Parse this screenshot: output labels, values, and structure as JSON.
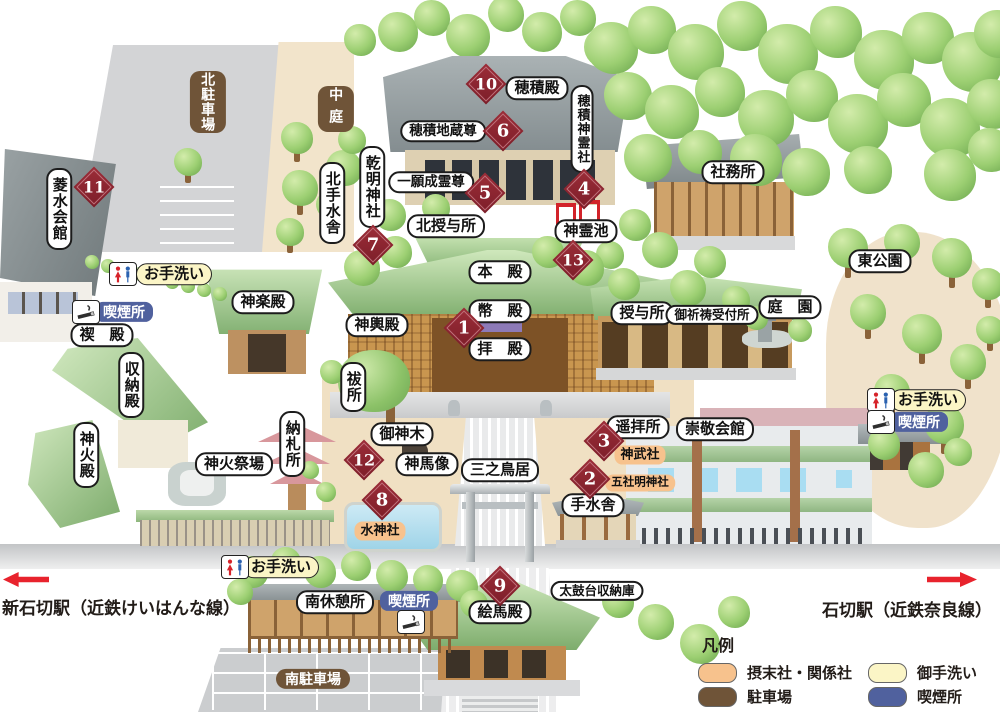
{
  "map_name": "石切神社 境内マップ",
  "colors": {
    "marker_red": "#8c2430",
    "sessha_orange": "#f7c28d",
    "parking_brown": "#6f5438",
    "toilet_yellow": "#fbf5c6",
    "smoking_blue": "#50619e",
    "arrow_red": "#e8232d"
  },
  "stations": {
    "left": "新石切駅（近鉄けいはんな線）",
    "right": "石切駅（近鉄奈良線）"
  },
  "legend": {
    "title": "凡例",
    "items": [
      {
        "id": "sessha",
        "label": "摂末社・関係社",
        "color": "#f7c28d"
      },
      {
        "id": "parking",
        "label": "駐車場",
        "color": "#6f5438"
      },
      {
        "id": "toilet",
        "label": "御手洗い",
        "color": "#fbf5c6"
      },
      {
        "id": "smoking",
        "label": "喫煙所",
        "color": "#50619e"
      }
    ]
  },
  "labels": [
    {
      "id": "kita-chushajo",
      "text": "北駐車場",
      "type": "brown",
      "v": true,
      "x": 208,
      "y": 102
    },
    {
      "id": "nakaniwa",
      "text": "中庭",
      "type": "brown",
      "v": true,
      "x": 336,
      "y": 109
    },
    {
      "id": "ryosui-kaikan",
      "text": "菱水会館",
      "type": "white",
      "v": true,
      "x": 59,
      "y": 209
    },
    {
      "id": "kita-temizusha",
      "text": "北手水舎",
      "type": "white",
      "v": true,
      "x": 332,
      "y": 203
    },
    {
      "id": "hozumi-den",
      "text": "穂積殿",
      "type": "white",
      "x": 537,
      "y": 88
    },
    {
      "id": "hozumi-shinreisha",
      "text": "穂積神霊社",
      "type": "white",
      "v": true,
      "x": 582,
      "y": 129
    },
    {
      "id": "hozumi-jizoson",
      "text": "穂積地蔵尊",
      "type": "white",
      "x": 443,
      "y": 131
    },
    {
      "id": "kenmei-jinja",
      "text": "乾明神社",
      "type": "white",
      "v": true,
      "x": 372,
      "y": 187
    },
    {
      "id": "ichigan-joreison",
      "text": "一願成霊尊",
      "type": "white",
      "x": 431,
      "y": 182
    },
    {
      "id": "shamusho",
      "text": "社務所",
      "type": "white",
      "x": 733,
      "y": 172
    },
    {
      "id": "kita-juyosho",
      "text": "北授与所",
      "type": "white",
      "x": 446,
      "y": 226
    },
    {
      "id": "shinrei-ike",
      "text": "神霊池",
      "type": "white",
      "x": 586,
      "y": 231
    },
    {
      "id": "higashi-koen",
      "text": "東公園",
      "type": "white",
      "x": 880,
      "y": 261
    },
    {
      "id": "otearai-nw",
      "text": "お手洗い",
      "type": "yellow",
      "x": 174,
      "y": 274
    },
    {
      "id": "kitsuenjo-nw",
      "text": "喫煙所",
      "type": "blue",
      "x": 124,
      "y": 312
    },
    {
      "id": "kagura-den",
      "text": "神楽殿",
      "type": "white",
      "x": 263,
      "y": 302
    },
    {
      "id": "misogi-den",
      "text": "禊　殿",
      "type": "white",
      "x": 102,
      "y": 335
    },
    {
      "id": "honden",
      "text": "本　殿",
      "type": "white",
      "x": 500,
      "y": 272
    },
    {
      "id": "heiden",
      "text": "幣　殿",
      "type": "white",
      "x": 500,
      "y": 311
    },
    {
      "id": "haiden",
      "text": "拝　殿",
      "type": "white",
      "x": 500,
      "y": 349
    },
    {
      "id": "shinyo-den",
      "text": "神輿殿",
      "type": "white",
      "x": 377,
      "y": 325
    },
    {
      "id": "juyosho",
      "text": "授与所",
      "type": "white",
      "x": 642,
      "y": 313
    },
    {
      "id": "gokito-uketsukesho",
      "text": "御祈祷受付所",
      "type": "white",
      "x": 712,
      "y": 315
    },
    {
      "id": "teien",
      "text": "庭　園",
      "type": "white",
      "x": 790,
      "y": 307
    },
    {
      "id": "shunoden",
      "text": "収納殿",
      "type": "white",
      "v": true,
      "x": 131,
      "y": 385
    },
    {
      "id": "haraedokoro",
      "text": "祓所",
      "type": "white",
      "v": true,
      "x": 353,
      "y": 387
    },
    {
      "id": "goshinboku",
      "text": "御神木",
      "type": "white",
      "x": 402,
      "y": 434
    },
    {
      "id": "shinba-zo",
      "text": "神馬像",
      "type": "white",
      "x": 427,
      "y": 464
    },
    {
      "id": "sannotorii",
      "text": "三之鳥居",
      "type": "white",
      "x": 500,
      "y": 470
    },
    {
      "id": "yohaisho",
      "text": "遥拝所",
      "type": "white",
      "x": 638,
      "y": 427
    },
    {
      "id": "jinmusha",
      "text": "神武社",
      "type": "orange",
      "x": 640,
      "y": 455
    },
    {
      "id": "gosha-myojinja",
      "text": "五社明神社",
      "type": "orange",
      "x": 640,
      "y": 483
    },
    {
      "id": "sukei-kaikan",
      "text": "崇敬会館",
      "type": "white",
      "x": 715,
      "y": 429
    },
    {
      "id": "otearai-e",
      "text": "お手洗い",
      "type": "yellow",
      "x": 928,
      "y": 400
    },
    {
      "id": "kitsuenjo-e",
      "text": "喫煙所",
      "type": "blue",
      "x": 919,
      "y": 422
    },
    {
      "id": "shinkaden",
      "text": "神火殿",
      "type": "white",
      "v": true,
      "x": 86,
      "y": 455
    },
    {
      "id": "shinka-saijo",
      "text": "神火祭場",
      "type": "white",
      "x": 234,
      "y": 464
    },
    {
      "id": "nosatsusho",
      "text": "納札所",
      "type": "white",
      "v": true,
      "x": 292,
      "y": 444
    },
    {
      "id": "suijinja",
      "text": "水神社",
      "type": "orange",
      "x": 380,
      "y": 531
    },
    {
      "id": "temizusha",
      "text": "手水舎",
      "type": "white",
      "x": 593,
      "y": 505
    },
    {
      "id": "otearai-s",
      "text": "お手洗い",
      "type": "yellow",
      "x": 281,
      "y": 567
    },
    {
      "id": "emaden",
      "text": "絵馬殿",
      "type": "white",
      "x": 500,
      "y": 612
    },
    {
      "id": "taikodai-shunoko",
      "text": "太鼓台収納庫",
      "type": "white",
      "x": 597,
      "y": 591
    },
    {
      "id": "minami-kyukeisho",
      "text": "南休憩所",
      "type": "white",
      "x": 335,
      "y": 602
    },
    {
      "id": "kitsuenjo-s",
      "text": "喫煙所",
      "type": "blue",
      "x": 409,
      "y": 601
    },
    {
      "id": "minami-chushajo",
      "text": "南駐車場",
      "type": "brown",
      "x": 313,
      "y": 679
    }
  ],
  "markers": [
    {
      "n": "1",
      "x": 464,
      "y": 328
    },
    {
      "n": "2",
      "x": 590,
      "y": 479
    },
    {
      "n": "3",
      "x": 604,
      "y": 441
    },
    {
      "n": "4",
      "x": 584,
      "y": 189
    },
    {
      "n": "5",
      "x": 485,
      "y": 193
    },
    {
      "n": "6",
      "x": 503,
      "y": 131
    },
    {
      "n": "7",
      "x": 373,
      "y": 245
    },
    {
      "n": "8",
      "x": 382,
      "y": 500
    },
    {
      "n": "9",
      "x": 500,
      "y": 586
    },
    {
      "n": "10",
      "x": 486,
      "y": 84
    },
    {
      "n": "11",
      "x": 94,
      "y": 187
    },
    {
      "n": "12",
      "x": 364,
      "y": 460
    },
    {
      "n": "13",
      "x": 573,
      "y": 260
    }
  ],
  "icons": [
    {
      "id": "restroom-nw",
      "type": "restroom",
      "x": 123,
      "y": 274
    },
    {
      "id": "smoking-nw",
      "type": "smoking",
      "x": 86,
      "y": 312
    },
    {
      "id": "restroom-e",
      "type": "restroom",
      "x": 881,
      "y": 400
    },
    {
      "id": "smoking-e",
      "type": "smoking",
      "x": 881,
      "y": 422
    },
    {
      "id": "restroom-s",
      "type": "restroom",
      "x": 235,
      "y": 567
    },
    {
      "id": "smoking-s",
      "type": "smoking",
      "x": 411,
      "y": 622
    }
  ]
}
